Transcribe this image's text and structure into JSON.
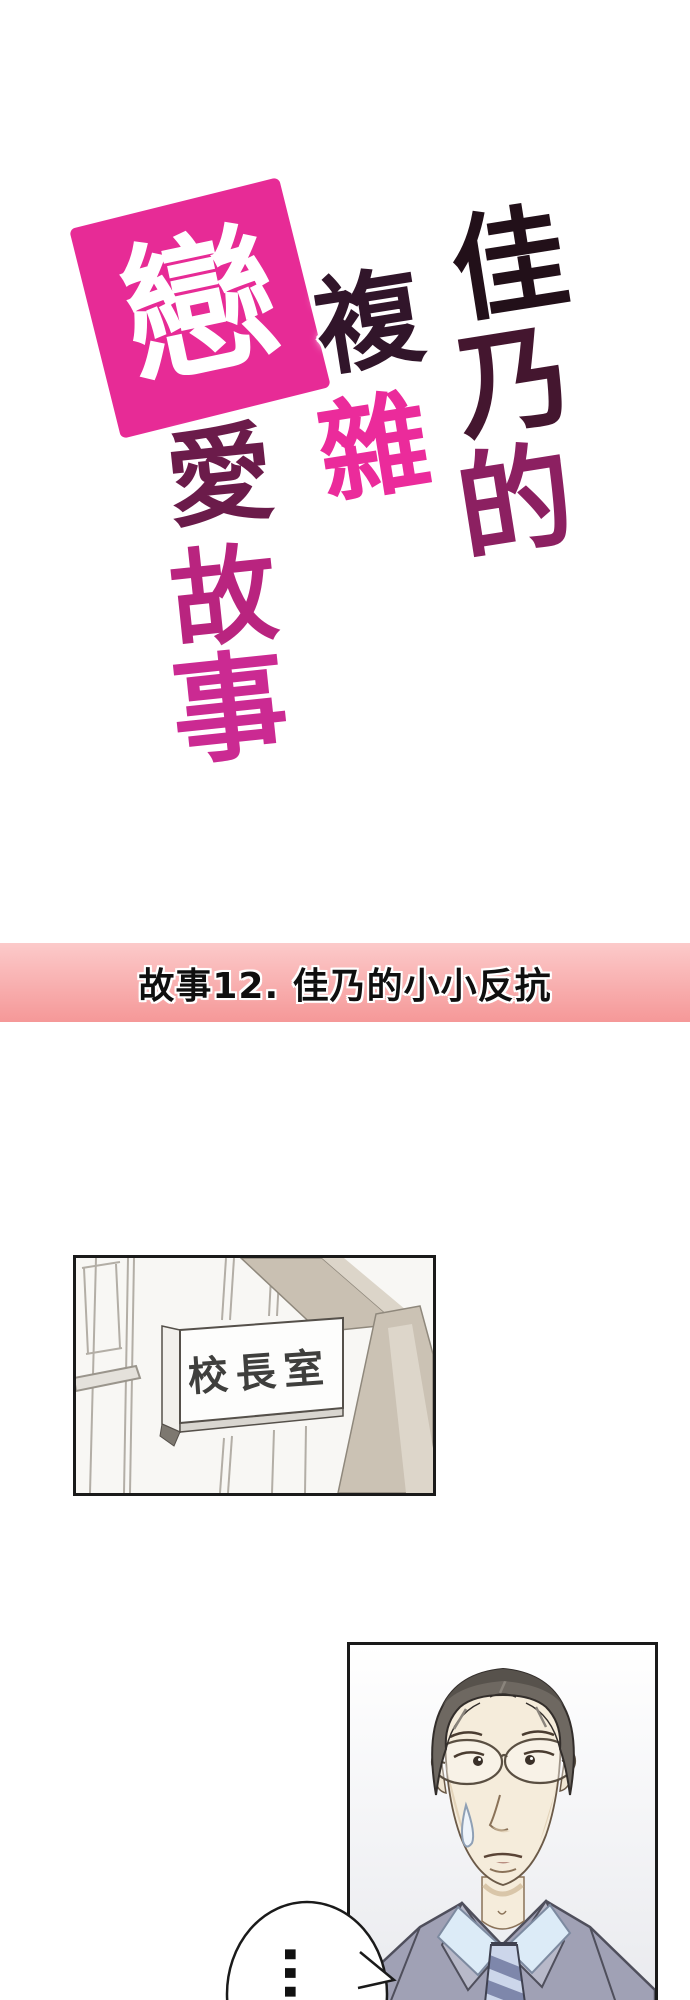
{
  "page": {
    "background": "#ffffff"
  },
  "logo": {
    "full_title": "佳乃的複雜戀愛故事",
    "badge": {
      "char": "戀",
      "bg": "#e72b96",
      "fg": "#ffffff"
    },
    "right_column": [
      {
        "char": "佳",
        "color": "#221019"
      },
      {
        "char": "乃",
        "color": "#44162f"
      },
      {
        "char": "的",
        "color": "#8c2061"
      }
    ],
    "middle_column": [
      {
        "char": "複",
        "color": "#31152a"
      },
      {
        "char": "雜",
        "color": "#eb2b9b"
      }
    ],
    "left_column": [
      {
        "char": "愛",
        "color": "#6b1b4a"
      },
      {
        "char": "故",
        "color": "#b9247f"
      },
      {
        "char": "事",
        "color": "#cb2a92"
      }
    ]
  },
  "chapter_banner": {
    "text": "故事12. 佳乃的小小反抗",
    "text_color": "#0f0f0f",
    "bg_top": "#fccaca",
    "bg_bottom": "#f59898"
  },
  "sign_panel": {
    "sign_text": "校長室",
    "sign_text_color": "#3f3f3d",
    "beam_color": "#c9c0b2",
    "line_color": "#aaa59d",
    "border_color": "#1a1a1a"
  },
  "principal_panel": {
    "border_color": "#1a1a1a",
    "speech_bubble": {
      "text": "…"
    }
  }
}
